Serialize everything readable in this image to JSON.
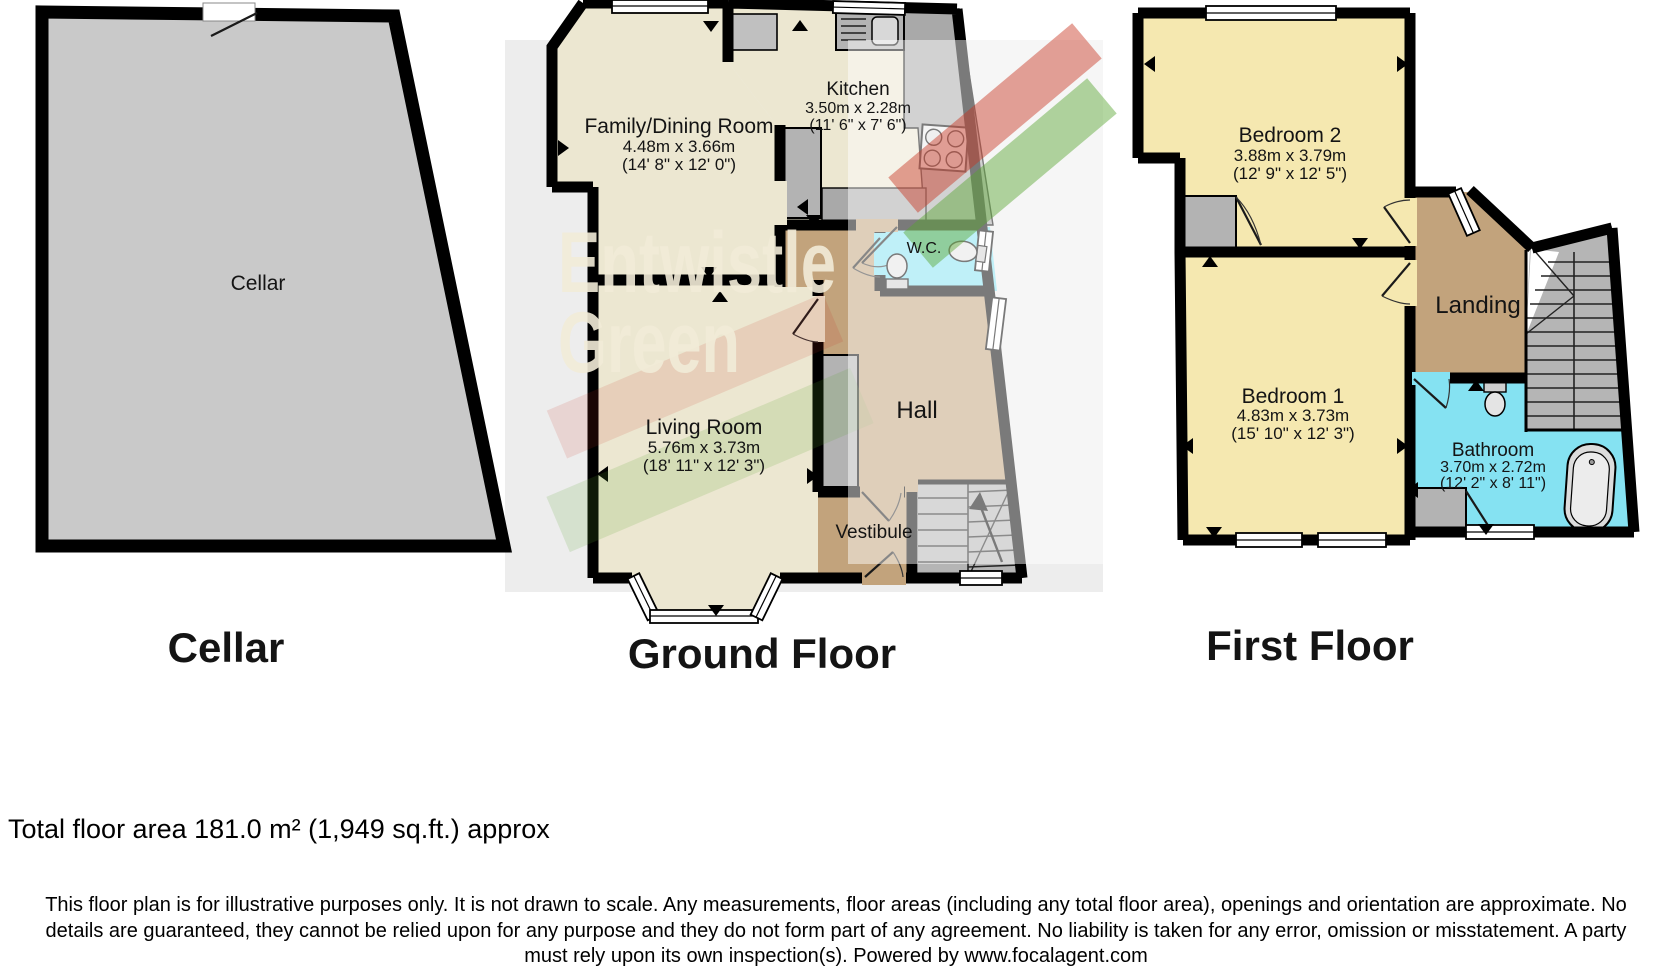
{
  "watermark": {
    "line1": "Entwistle",
    "line2": "Green"
  },
  "cellar": {
    "title": "Cellar",
    "room": {
      "name": "Cellar"
    }
  },
  "ground_floor": {
    "title": "Ground Floor",
    "family_dining": {
      "name": "Family/Dining Room",
      "metric": "4.48m x 3.66m",
      "imperial": "(14' 8\" x 12' 0\")"
    },
    "kitchen": {
      "name": "Kitchen",
      "metric": "3.50m x 2.28m",
      "imperial": "(11' 6\" x 7' 6\")"
    },
    "wc": {
      "name": "W.C."
    },
    "living_room": {
      "name": "Living Room",
      "metric": "5.76m x 3.73m",
      "imperial": "(18' 11\" x 12' 3\")"
    },
    "hall": {
      "name": "Hall"
    },
    "vestibule": {
      "name": "Vestibule"
    }
  },
  "first_floor": {
    "title": "First Floor",
    "bedroom2": {
      "name": "Bedroom 2",
      "metric": "3.88m x 3.79m",
      "imperial": "(12' 9\" x 12' 5\")"
    },
    "bedroom1": {
      "name": "Bedroom 1",
      "metric": "4.83m x 3.73m",
      "imperial": "(15' 10\" x 12' 3\")"
    },
    "landing": {
      "name": "Landing"
    },
    "bathroom": {
      "name": "Bathroom",
      "metric": "3.70m x 2.72m",
      "imperial": "(12' 2\" x 8' 11\")"
    }
  },
  "footer": {
    "total_area": "Total floor area 181.0 m² (1,949 sq.ft.) approx",
    "disclaimer_line1": "This floor plan is for illustrative purposes only. It is not drawn to scale. Any measurements, floor areas (including any total floor area), openings and orientation are approximate. No",
    "disclaimer_line2": "details are guaranteed, they cannot be relied upon for any purpose and they do not form part of any agreement. No liability is taken for any error, omission or misstatement. A party",
    "disclaimer_line3": "must rely upon its own inspection(s). Powered by www.focalagent.com"
  },
  "colors": {
    "wall": "#000000",
    "cream": "#ece7d1",
    "tan": "#c2a37c",
    "cyan": "#85e2f2",
    "yellow": "#f5e8b0",
    "cellar_gray": "#c9c9c9",
    "fixture_gray": "#b3b3b3",
    "stairs_gray": "#b5b5b5",
    "backdrop_gray": "#ededed",
    "brand_red": "#c8321f",
    "brand_green": "#57a32e",
    "watermark_cream": "#f2ecd8"
  }
}
